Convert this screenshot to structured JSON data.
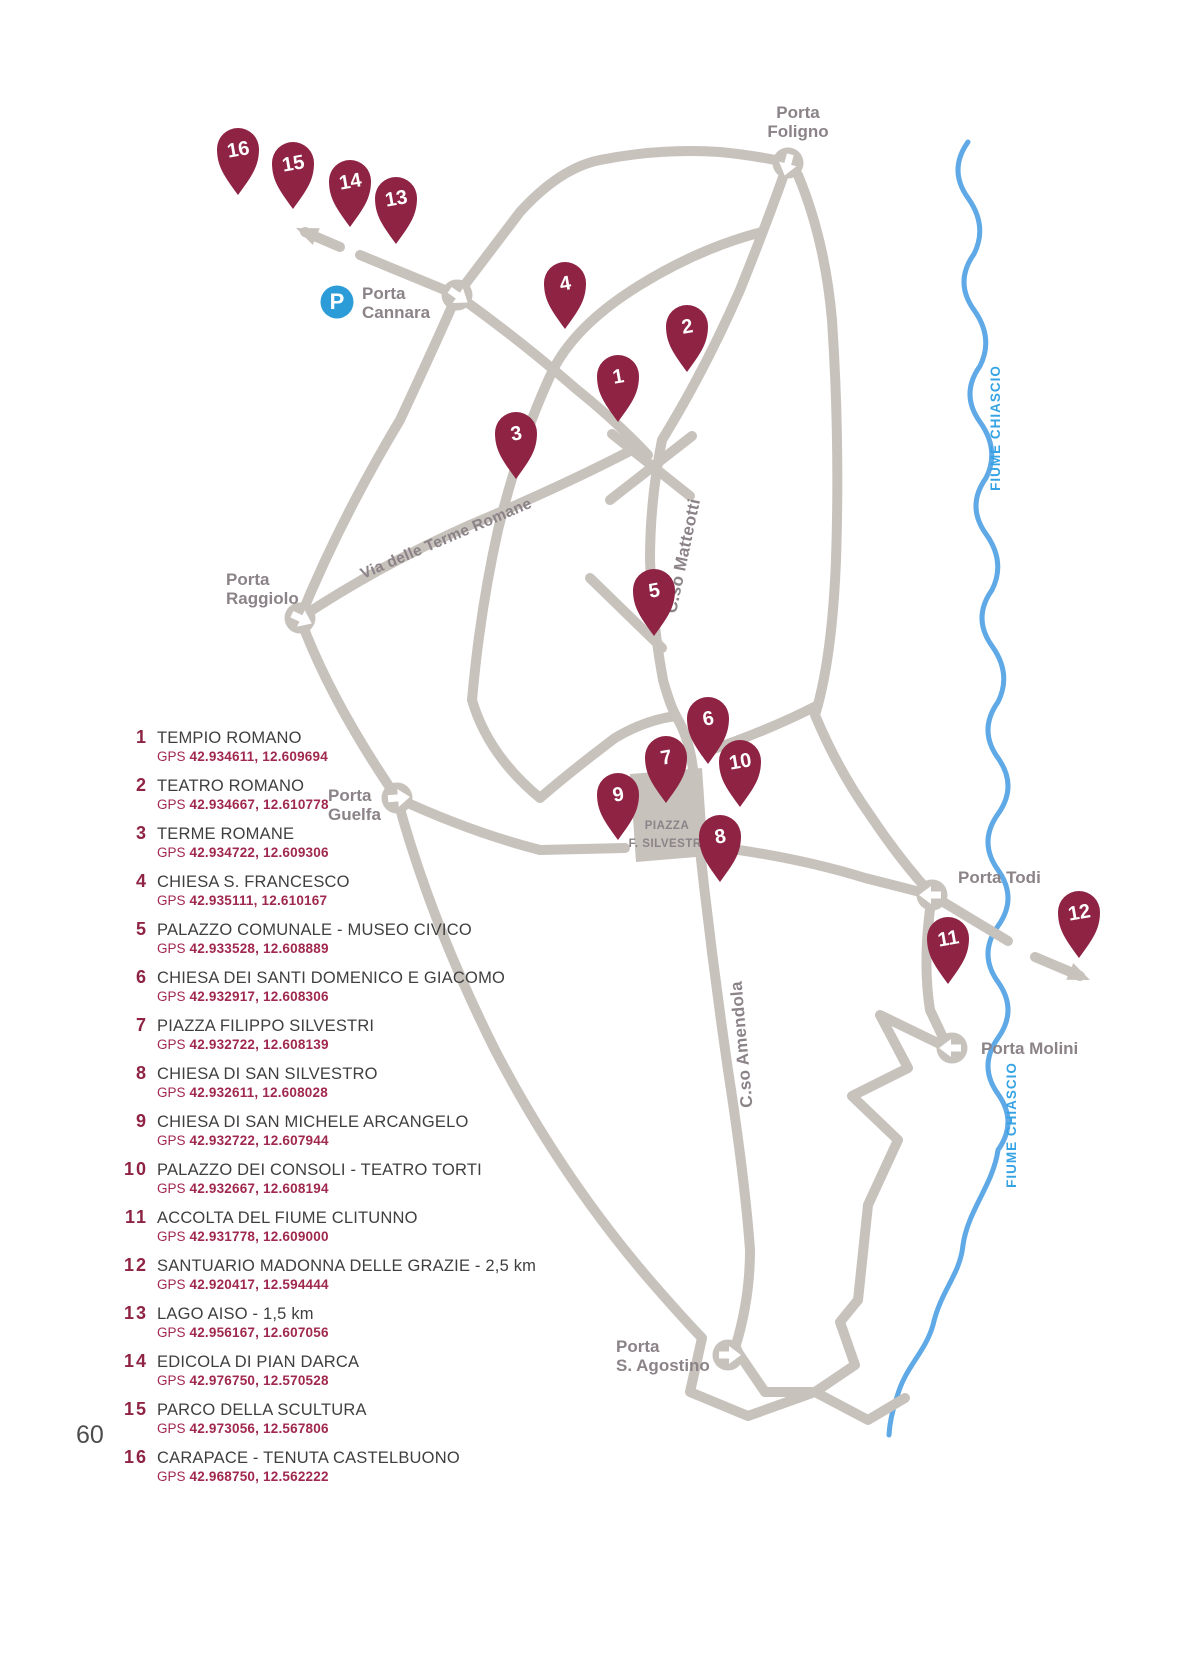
{
  "page": {
    "number": "60"
  },
  "colors": {
    "pin": "#8e2344",
    "road": "#c8c2bc",
    "river": "#5fa9e6",
    "river_text": "#36a3e4",
    "gray_label": "#8b8388",
    "legend_text": "#3f3f40",
    "gps_text": "#a0284f",
    "parking_blue": "#2b9cd8"
  },
  "map": {
    "parking": {
      "label": "P",
      "x": 337,
      "y": 302
    },
    "piazza": {
      "line1": "PIAZZA",
      "line2": "F. SILVESTRI",
      "x": 667,
      "y": 829
    },
    "gates": [
      {
        "id": "porta-foligno",
        "lines": [
          "Porta",
          "Foligno"
        ],
        "x": 788,
        "y": 163,
        "deg": 105,
        "lx": 798,
        "ly": 118,
        "anchor": "middle"
      },
      {
        "id": "porta-cannara",
        "lines": [
          "Porta",
          "Cannara"
        ],
        "x": 457,
        "y": 295,
        "deg": 35,
        "lx": 362,
        "ly": 299,
        "anchor": "start"
      },
      {
        "id": "porta-raggiolo",
        "lines": [
          "Porta",
          "Raggiolo"
        ],
        "x": 300,
        "y": 618,
        "deg": 25,
        "lx": 226,
        "ly": 585,
        "anchor": "start"
      },
      {
        "id": "porta-guelfa",
        "lines": [
          "Porta",
          "Guelfa"
        ],
        "x": 397,
        "y": 798,
        "deg": -5,
        "lx": 328,
        "ly": 801,
        "anchor": "start"
      },
      {
        "id": "porta-todi",
        "lines": [
          "Porta Todi"
        ],
        "x": 932,
        "y": 895,
        "deg": 180,
        "lx": 958,
        "ly": 883,
        "anchor": "start"
      },
      {
        "id": "porta-molini",
        "lines": [
          "Porta Molini"
        ],
        "x": 952,
        "y": 1048,
        "deg": 180,
        "lx": 981,
        "ly": 1054,
        "anchor": "start"
      },
      {
        "id": "porta-s-agostino",
        "lines": [
          "Porta",
          "S. Agostino"
        ],
        "x": 728,
        "y": 1355,
        "deg": 0,
        "lx": 616,
        "ly": 1352,
        "anchor": "start"
      }
    ],
    "markers": [
      {
        "n": "1",
        "x": 618,
        "y": 375
      },
      {
        "n": "2",
        "x": 687,
        "y": 325
      },
      {
        "n": "3",
        "x": 516,
        "y": 432
      },
      {
        "n": "4",
        "x": 565,
        "y": 282
      },
      {
        "n": "5",
        "x": 654,
        "y": 589
      },
      {
        "n": "6",
        "x": 708,
        "y": 717
      },
      {
        "n": "7",
        "x": 666,
        "y": 756
      },
      {
        "n": "8",
        "x": 720,
        "y": 835
      },
      {
        "n": "9",
        "x": 618,
        "y": 793
      },
      {
        "n": "10",
        "x": 740,
        "y": 760
      },
      {
        "n": "11",
        "x": 948,
        "y": 937
      },
      {
        "n": "12",
        "x": 1079,
        "y": 911
      },
      {
        "n": "13",
        "x": 396,
        "y": 197
      },
      {
        "n": "14",
        "x": 350,
        "y": 180
      },
      {
        "n": "15",
        "x": 293,
        "y": 162
      },
      {
        "n": "16",
        "x": 238,
        "y": 148
      }
    ],
    "street_labels": [
      {
        "text": "Via delle Terme Romane",
        "x": 448,
        "y": 543,
        "rotate": -23,
        "size": 15.5
      },
      {
        "text": "C.so Matteotti",
        "x": 688,
        "y": 557,
        "rotate": -78,
        "size": 17
      },
      {
        "text": "C.so Amendola",
        "x": 747,
        "y": 1044,
        "rotate": -95,
        "size": 17
      }
    ],
    "river_labels": [
      {
        "text": "FIUME CHIASCIO",
        "x": 1000,
        "y": 428,
        "rotate": -90
      },
      {
        "text": "FIUME CHIASCIO",
        "x": 1016,
        "y": 1125,
        "rotate": -90
      }
    ]
  },
  "legend": {
    "gps_prefix": "GPS",
    "items": [
      {
        "num": "1",
        "name": "TEMPIO ROMANO",
        "gps": "42.934611, 12.609694"
      },
      {
        "num": "2",
        "name": "TEATRO ROMANO",
        "gps": "42.934667, 12.610778"
      },
      {
        "num": "3",
        "name": "TERME ROMANE",
        "gps": "42.934722, 12.609306"
      },
      {
        "num": "4",
        "name": "CHIESA S. FRANCESCO",
        "gps": "42.935111, 12.610167"
      },
      {
        "num": "5",
        "name": "PALAZZO COMUNALE - MUSEO CIVICO",
        "gps": "42.933528, 12.608889"
      },
      {
        "num": "6",
        "name": "CHIESA DEI SANTI DOMENICO E GIACOMO",
        "gps": "42.932917, 12.608306"
      },
      {
        "num": "7",
        "name": "PIAZZA FILIPPO SILVESTRI",
        "gps": "42.932722, 12.608139"
      },
      {
        "num": "8",
        "name": "CHIESA DI SAN SILVESTRO",
        "gps": "42.932611, 12.608028"
      },
      {
        "num": "9",
        "name": "CHIESA DI SAN MICHELE ARCANGELO",
        "gps": "42.932722, 12.607944"
      },
      {
        "num": "10",
        "name": "PALAZZO DEI CONSOLI - TEATRO TORTI",
        "gps": "42.932667, 12.608194"
      },
      {
        "num": "11",
        "name": "ACCOLTA DEL FIUME CLITUNNO",
        "gps": "42.931778, 12.609000"
      },
      {
        "num": "12",
        "name": "SANTUARIO MADONNA DELLE GRAZIE - 2,5 km",
        "gps": "42.920417, 12.594444"
      },
      {
        "num": "13",
        "name": "LAGO AISO - 1,5 km",
        "gps": "42.956167, 12.607056"
      },
      {
        "num": "14",
        "name": "EDICOLA DI PIAN DARCA",
        "gps": "42.976750, 12.570528"
      },
      {
        "num": "15",
        "name": "PARCO DELLA SCULTURA",
        "gps": "42.973056, 12.567806"
      },
      {
        "num": "16",
        "name": "CARAPACE - TENUTA CASTELBUONO",
        "gps": "42.968750, 12.562222"
      }
    ]
  }
}
